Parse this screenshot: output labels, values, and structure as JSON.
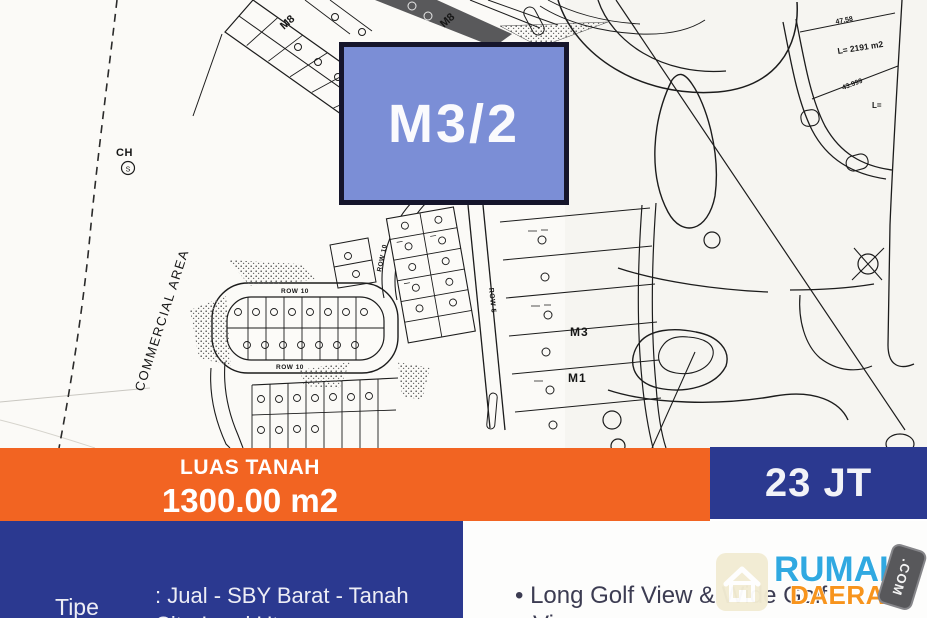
{
  "badge": {
    "label": "M3/2"
  },
  "banner": {
    "land_area_label": "LUAS TANAH",
    "land_area_value": "1300.00 m2",
    "price": "23 JT"
  },
  "details": {
    "type_label": "Tipe",
    "type_value_line1": ": Jual - SBY Barat - Tanah",
    "type_value_line2": "CitraLand Uta",
    "features_line1": "• Long Golf View & Wide Golf",
    "features_line2": "View"
  },
  "logo": {
    "word_top": "RUMAH",
    "word_bottom": "DAERAH",
    "stamp": ".COM"
  },
  "map": {
    "labels": {
      "commercial_area": "COMMERCIAL AREA",
      "ch": "CH",
      "ch_sub": "S",
      "m8_a": "M8",
      "m8_b": "M8",
      "row10_top": "ROW 10",
      "row10_bottom": "ROW 10",
      "row10_side": "ROW 10",
      "row5": "ROW 5",
      "m3": "M3",
      "m1": "M1",
      "dim_a": "47.58",
      "area_a": "L= 2191 m2",
      "dim_b": "43.999",
      "area_b": "L="
    }
  },
  "colors": {
    "banner_orange": "#F26422",
    "banner_blue": "#2B3990",
    "badge_fill": "#7B8ED6",
    "badge_border": "#15152B",
    "logo_blue": "#30A9E1",
    "logo_orange": "#F7941D"
  }
}
